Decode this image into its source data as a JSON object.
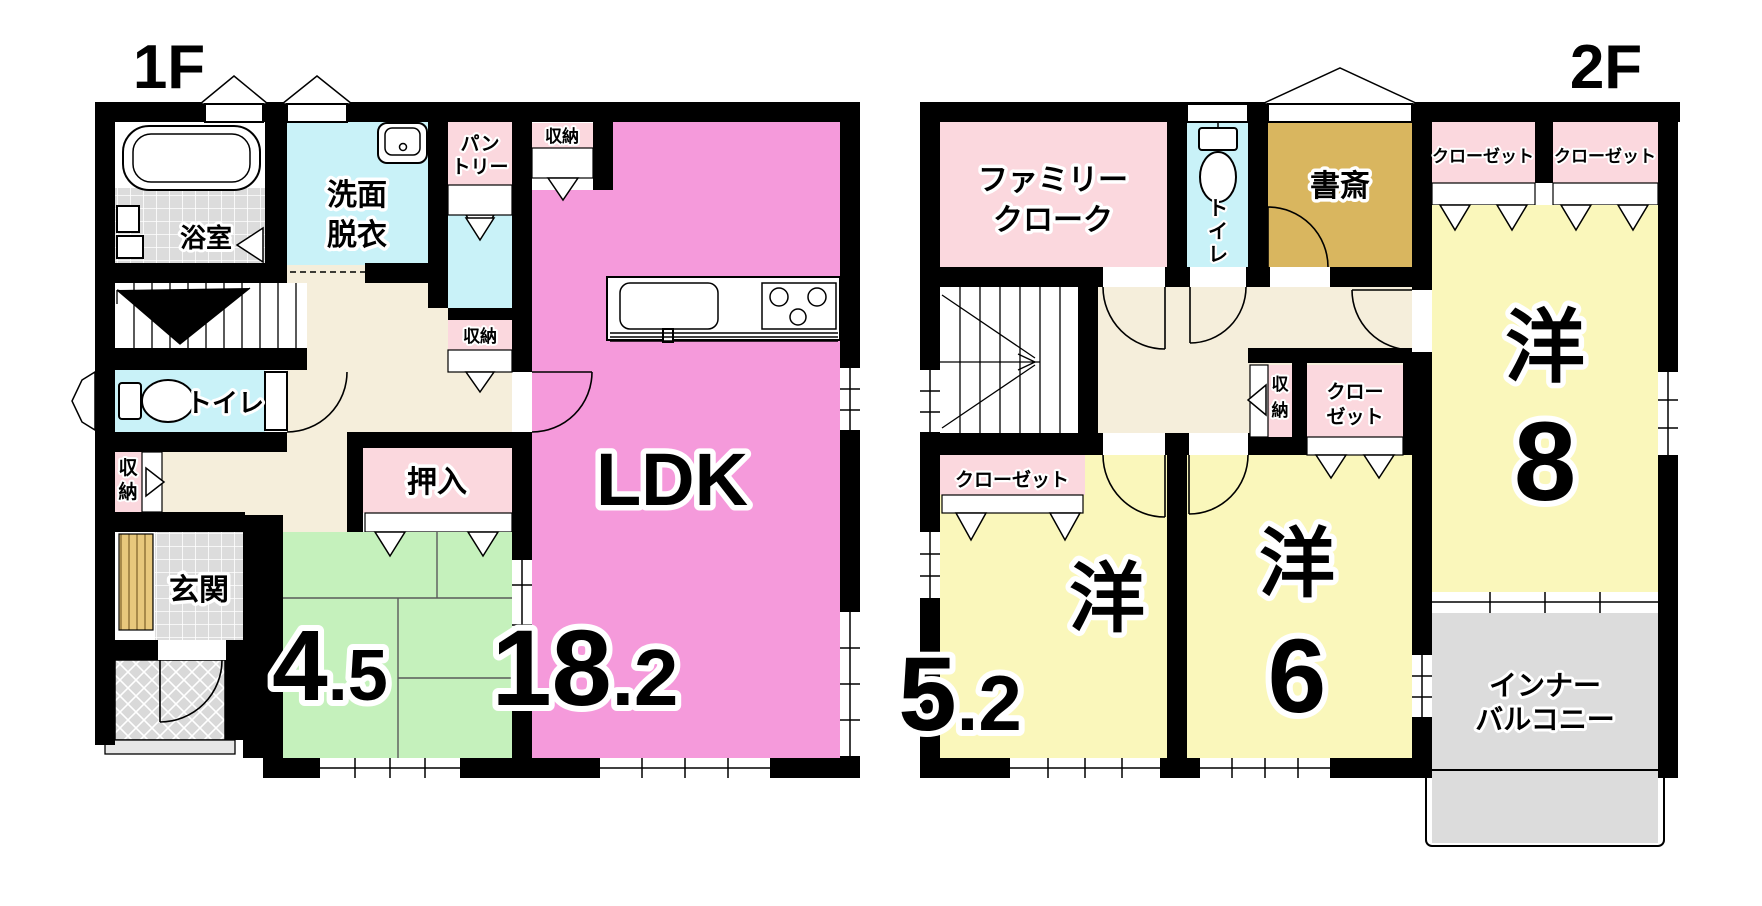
{
  "colors": {
    "wall": "#000000",
    "ldk_pink": "#F59ADB",
    "storage_pink": "#FBD8DE",
    "water_cyan": "#C9F2F8",
    "bathtub_cyan": "#5FE8EF",
    "hall_cream": "#F5EEDB",
    "tatami_green": "#C5F1BC",
    "western_yellow": "#FAF7BB",
    "study_gold": "#D9B65F",
    "tile_gray": "#DCDCDC",
    "wood_slat": "#E8C87C"
  },
  "floor1": {
    "title": "1F",
    "rooms": {
      "bath": "浴室",
      "washroom": [
        "洗面",
        "脱衣"
      ],
      "pantry": [
        "パン",
        "トリー"
      ],
      "storage_top": "収納",
      "storage_mid": "収納",
      "storage_side": "収納",
      "toilet": "トイレ",
      "closet": "押入",
      "entrance": "玄関",
      "tatami": {
        "int": "4",
        "dec": ".5"
      },
      "ldk": {
        "name": "LDK",
        "int": "18",
        "dec": ".2"
      }
    }
  },
  "floor2": {
    "title": "2F",
    "rooms": {
      "family_cloak": [
        "ファミリー",
        "クローク"
      ],
      "toilet": "トイレ",
      "study": "書斎",
      "closet_a": "クローゼット",
      "closet_b": "クローゼット",
      "closet_c": "クローゼット",
      "closet_mid": [
        "クロー",
        "ゼット"
      ],
      "storage": "収納",
      "room8": {
        "kanji": "洋",
        "num": "8"
      },
      "room52": {
        "kanji": "洋",
        "int": "5",
        "dec": ".2"
      },
      "room6": {
        "kanji": "洋",
        "num": "6"
      },
      "balcony": [
        "インナー",
        "バルコニー"
      ]
    }
  }
}
